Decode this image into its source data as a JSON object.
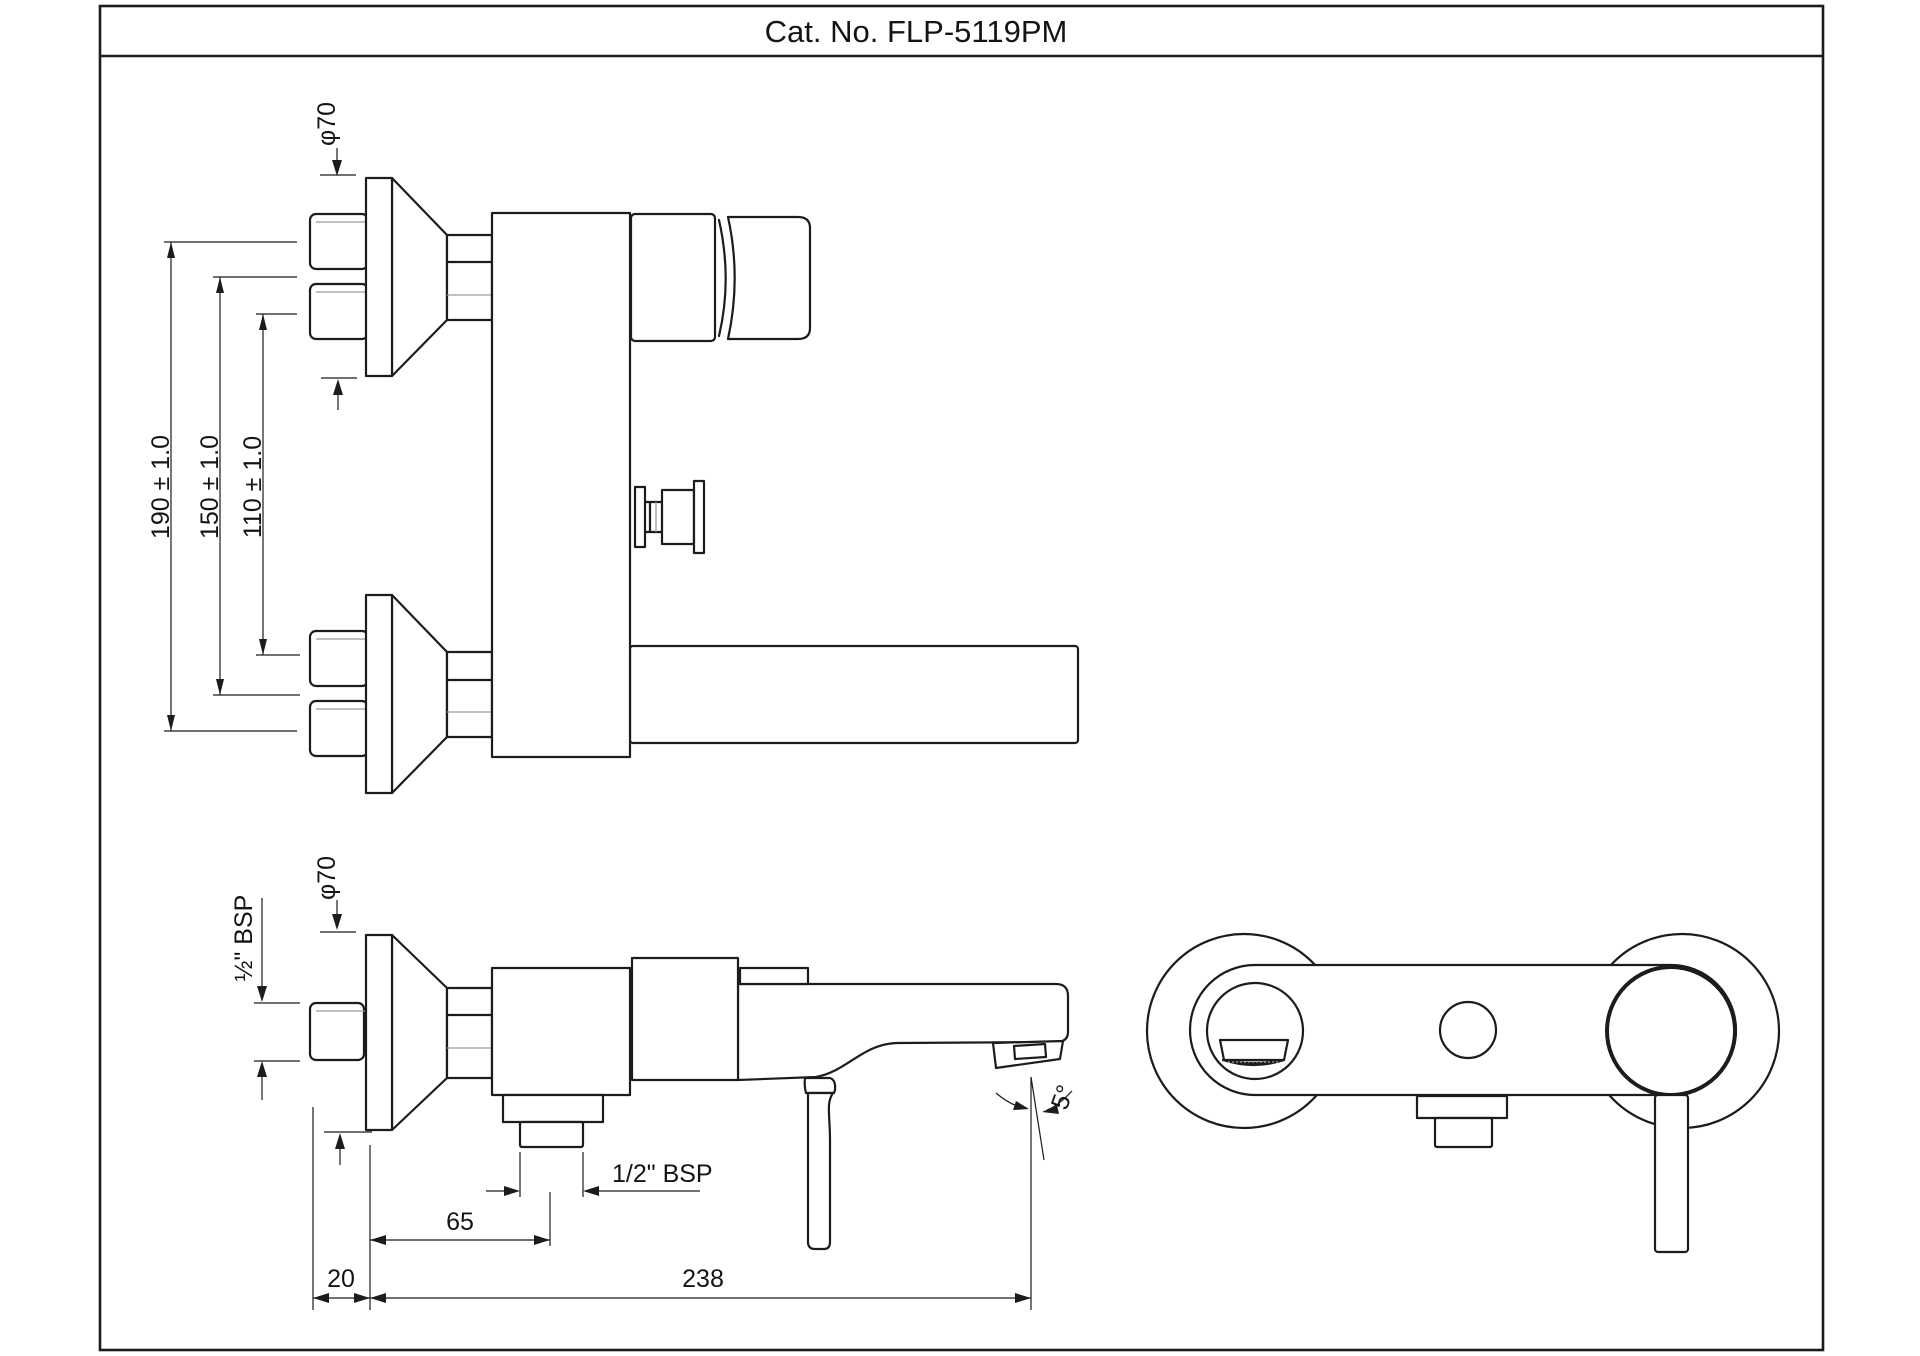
{
  "drawing": {
    "title": "Cat. No. FLP-5119PM",
    "top_view": {
      "dia_label": "φ70",
      "dim_190": "190 ± 1.0",
      "dim_150": "150 ± 1.0",
      "dim_110": "110 ± 1.0"
    },
    "side_view": {
      "dia_label": "φ70",
      "inlet_thread_label": "½\" BSP",
      "outlet_thread_label": "1/2\" BSP",
      "dim_20": "20",
      "dim_65": "65",
      "dim_238": "238",
      "angle_label": "5°"
    },
    "colors": {
      "line": "#1c1c1c",
      "background": "#ffffff"
    }
  }
}
